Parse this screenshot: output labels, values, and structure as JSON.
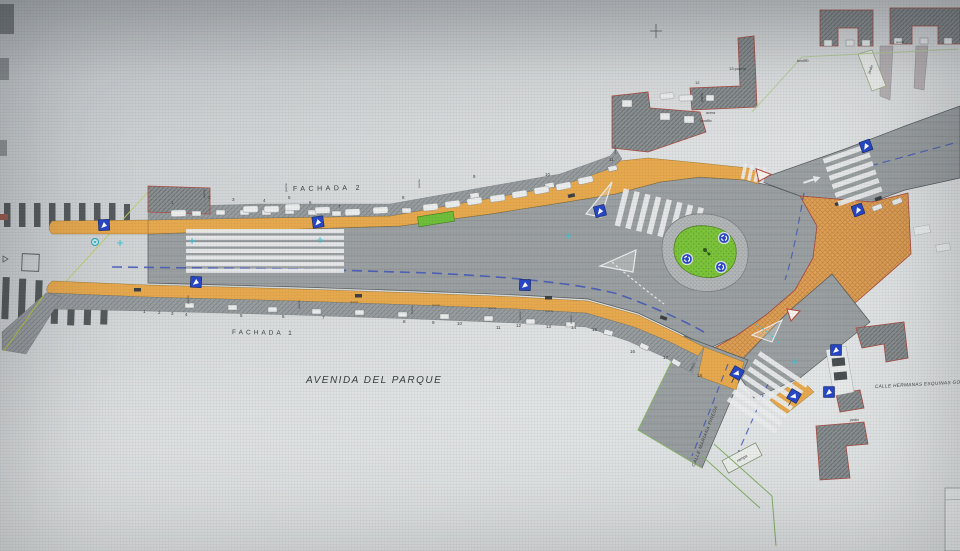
{
  "plan": {
    "avenue_label": "AVENIDA DEL PARQUE",
    "street_mariana": "CALLE MARIANA PINEDA",
    "street_hermanas": "CALLE HERMANAS ESQUINAS GO",
    "facade2": {
      "label": "FACHADA 2",
      "numbers": [
        "1",
        "2",
        "3",
        "4",
        "5",
        "6",
        "7",
        "8",
        "9",
        "10",
        "11"
      ]
    },
    "facade1": {
      "label": "FACHADA 1",
      "numbers": [
        "1",
        "2",
        "3",
        "4",
        "5",
        "6",
        "7",
        "8",
        "9",
        "10",
        "11",
        "12",
        "13",
        "14",
        "15",
        "16",
        "17",
        "18"
      ]
    },
    "labels": {
      "bordillo": "bordillo",
      "acera": "acera",
      "puerta": "puerta",
      "puerta13": "13 puerta",
      "num12": "12",
      "jardin": "jardin",
      "rampa": "rampa"
    },
    "icons": {
      "pedestrian_crossing_sign": "blue square, white arrow",
      "roundabout_sign": "blue circle, white rotating arrows",
      "yield_marking": "red-bordered white triangle",
      "tree_symbol": "dark green glyph on island"
    },
    "colors": {
      "road": "#9ba0a2",
      "sidewalk_orange": "#e7a94e",
      "plaza_brick": "#dfa057",
      "island_green": "#7cc43a",
      "sign_blue": "#2747c5",
      "centerline_blue": "#4056b8",
      "facade_hatch": "#989da0",
      "building_hatch": "#8b9092",
      "curb_red": "#a84c42",
      "curb_green": "#9fc36a",
      "marker_cyan": "#3fc4d2"
    }
  }
}
